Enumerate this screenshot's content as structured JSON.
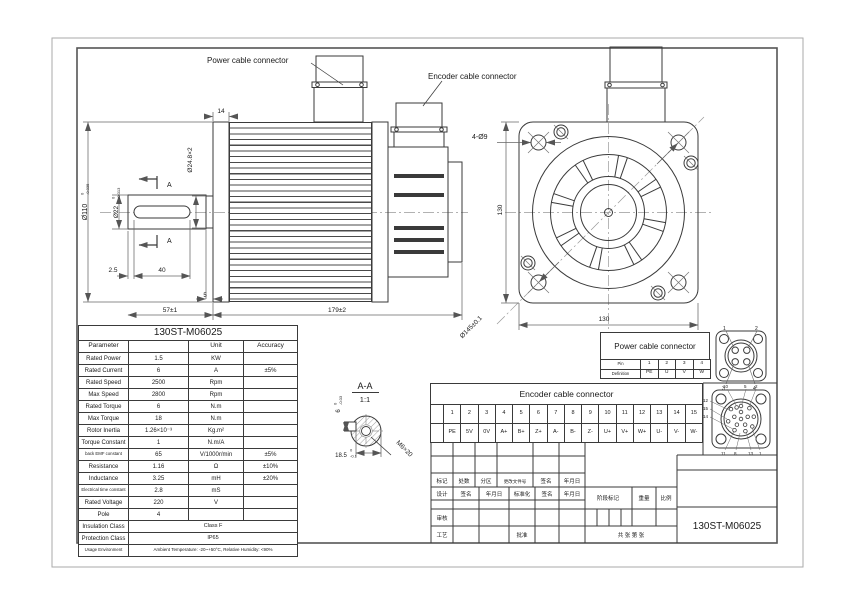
{
  "callouts": {
    "power": "Power cable connector",
    "encoder": "Encoder cable connector"
  },
  "side": {
    "d14": "14",
    "d248": "Ø24.8×2",
    "d110": "Ø110",
    "d110t0": "0",
    "d110t1": "-0.035",
    "d22": "Ø22",
    "d22t0": "0",
    "d22t1": "-0.013",
    "d25": "2.5",
    "d40": "40",
    "d5": "5",
    "d57": "57±1",
    "d179": "179±2",
    "secA1": "A",
    "secA2": "A"
  },
  "front": {
    "holes": "4-Ø9",
    "h130": "130",
    "w130": "130",
    "d145": "Ø145±0.1"
  },
  "section": {
    "name": "A-A",
    "scale": "1:1",
    "d6": "6",
    "d6t0": "0",
    "d6t1": "-0.03",
    "d185": "18.5",
    "d185t0": "0",
    "d185t1": "-0.1",
    "thread": "M6×20"
  },
  "param_table": {
    "title": "130ST-M06025",
    "header": [
      "Parameter",
      "",
      "Unit",
      "Accuracy"
    ],
    "rows": [
      [
        "Rated Power",
        "1.5",
        "KW",
        ""
      ],
      [
        "Rated Current",
        "6",
        "A",
        "±5%"
      ],
      [
        "Rated Speed",
        "2500",
        "Rpm",
        ""
      ],
      [
        "Max Speed",
        "2800",
        "Rpm",
        ""
      ],
      [
        "Rated Torque",
        "6",
        "N.m",
        ""
      ],
      [
        "Max Torque",
        "18",
        "N.m",
        ""
      ],
      [
        "Rotor Inertia",
        "1.26×10⁻³",
        "Kg.m²",
        ""
      ],
      [
        "Torque Constant",
        "1",
        "N.m/A",
        ""
      ],
      [
        "back EMF constant",
        "65",
        "V/1000r/min",
        "±5%"
      ],
      [
        "Resistance",
        "1.16",
        "Ω",
        "±10%"
      ],
      [
        "Inductance",
        "3.25",
        "mH",
        "±20%"
      ],
      [
        "Electrical time constant",
        "2.8",
        "mS",
        ""
      ],
      [
        "Rated Voltage",
        "220",
        "V",
        ""
      ],
      [
        "Pole",
        "4",
        "",
        ""
      ]
    ],
    "span_rows": [
      [
        "Insulation Class",
        "Class F"
      ],
      [
        "Protection Class",
        "IP65"
      ],
      [
        "Usage Environment",
        "Ambient Temperature: -20~+50°C, Relative Humidity: <90%"
      ]
    ]
  },
  "power_block": {
    "title": "Power cable connector",
    "row0": "Pin",
    "row1": "Definition",
    "pins": [
      "1",
      "2",
      "3",
      "4"
    ],
    "defs": [
      "PE",
      "U",
      "V",
      "W"
    ],
    "drawing_labels": [
      "1",
      "2",
      "3",
      "4"
    ]
  },
  "encoder_block": {
    "title": "Encoder cable connector",
    "pins": [
      "1",
      "2",
      "3",
      "4",
      "5",
      "6",
      "7",
      "8",
      "9",
      "10",
      "11",
      "12",
      "13",
      "14",
      "15"
    ],
    "defs": [
      "PE",
      "5V",
      "0V",
      "A+",
      "B+",
      "Z+",
      "A-",
      "B-",
      "Z-",
      "U+",
      "V+",
      "W+",
      "U-",
      "V-",
      "W-"
    ],
    "drawing_labels": [
      "10",
      "5",
      "2",
      "12",
      "15",
      "14",
      "11",
      "8",
      "13",
      "1"
    ]
  },
  "title_block": {
    "r2": [
      "标记",
      "处数",
      "分区",
      "更改文件号",
      "签名",
      "年月日"
    ],
    "r3": [
      "设计",
      "签名",
      "年月日",
      "标准化",
      "签名",
      "年月日"
    ],
    "audit": "审核",
    "craft": "工艺",
    "approve": "批准",
    "stage": "阶段标记",
    "weight": "重量",
    "scale": "比例",
    "sheets": "共  张  第  张",
    "model": "130ST-M06025"
  }
}
